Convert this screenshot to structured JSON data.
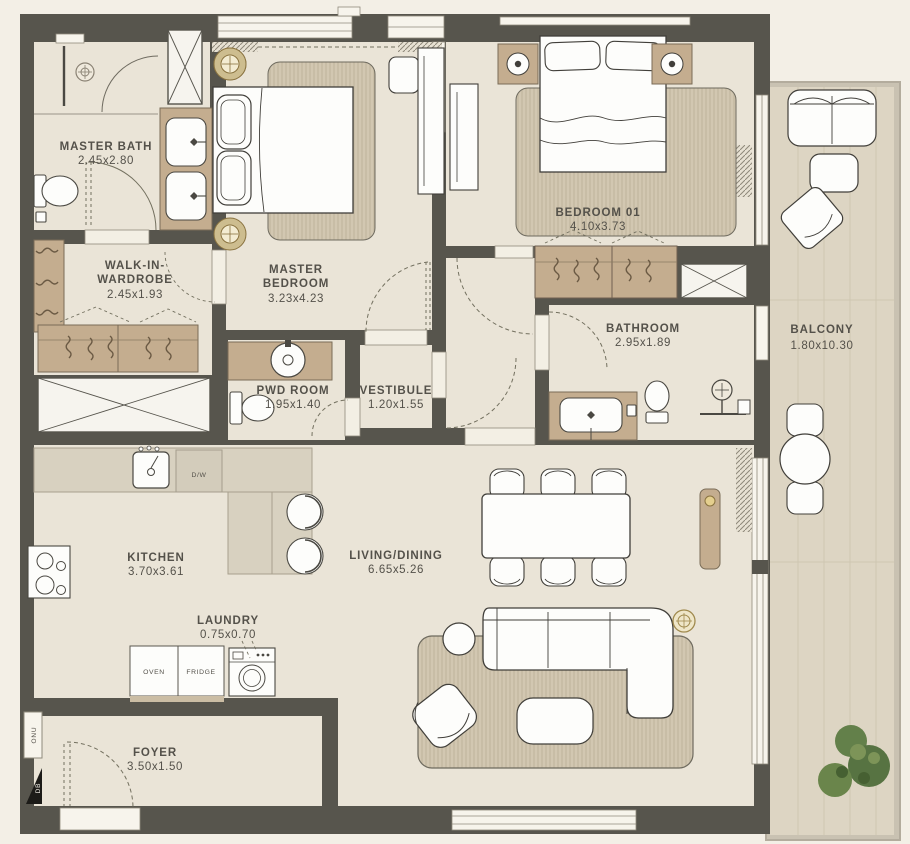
{
  "title": "Apartment Floor Plan",
  "rooms": {
    "master_bath": {
      "name": "MASTER BATH",
      "dims": "2.45x2.80"
    },
    "walk_in_wardrobe": {
      "line1": "WALK-IN-",
      "line2": "WARDROBE",
      "dims": "2.45x1.93"
    },
    "master_bedroom": {
      "line1": "MASTER",
      "line2": "BEDROOM",
      "dims": "3.23x4.23"
    },
    "bedroom_01": {
      "name": "BEDROOM 01",
      "dims": "4.10x3.73"
    },
    "bathroom": {
      "name": "BATHROOM",
      "dims": "2.95x1.89"
    },
    "balcony": {
      "name": "BALCONY",
      "dims": "1.80x10.30"
    },
    "pwd_room": {
      "name": "PWD ROOM",
      "dims": "1.95x1.40"
    },
    "vestibule": {
      "name": "VESTIBULE",
      "dims": "1.20x1.55"
    },
    "kitchen": {
      "name": "KITCHEN",
      "dims": "3.70x3.61"
    },
    "living_dining": {
      "name": "LIVING/DINING",
      "dims": "6.65x5.26"
    },
    "laundry": {
      "name": "LAUNDRY",
      "dims": "0.75x0.70"
    },
    "foyer": {
      "name": "FOYER",
      "dims": "3.50x1.50"
    }
  },
  "appliances": {
    "oven": "OVEN",
    "fridge": "FRIDGE",
    "dishwasher": "D/W"
  },
  "utility": {
    "onu": "ONU",
    "db": "DB"
  },
  "colors": {
    "background": "#f3efe6",
    "wall": "#57554d",
    "floor": "#eae4d7",
    "balcony_floor": "#ddd5c3",
    "wood": "#c4ad8f",
    "counter": "#d8d1c0",
    "rug": "#d2c7b1",
    "text": "#54514a",
    "accent_gold": "#b49a55",
    "plant": "#5c7a43"
  }
}
